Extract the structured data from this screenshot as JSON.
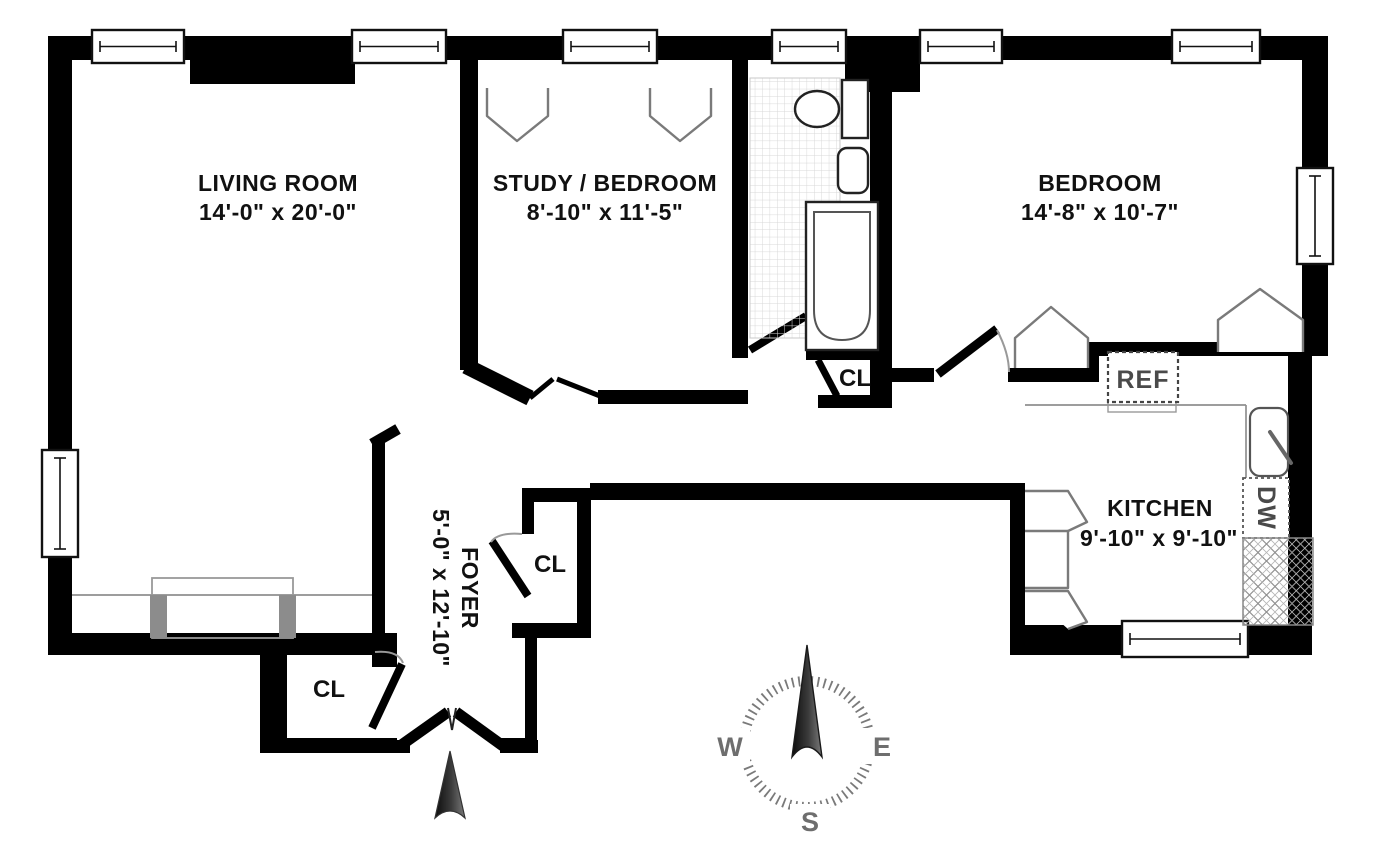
{
  "rooms": {
    "living": {
      "name": "LIVING ROOM",
      "dims": "14'-0\" x 20'-0\""
    },
    "study": {
      "name": "STUDY / BEDROOM",
      "dims": "8'-10\" x 11'-5\""
    },
    "bedroom": {
      "name": "BEDROOM",
      "dims": "14'-8\" x 10'-7\""
    },
    "kitchen": {
      "name": "KITCHEN",
      "dims": "9'-10\" x 9'-10\""
    },
    "foyer": {
      "name": "FOYER",
      "dims": "5'-0\" x 12'-10\""
    }
  },
  "closets": {
    "bath_closet": "CL",
    "foyer_closet": "CL",
    "entry_closet": "CL"
  },
  "appliances": {
    "refrigerator": "REF",
    "dishwasher": "DW"
  },
  "compass": {
    "west": "W",
    "east": "E",
    "south": "S"
  },
  "colors": {
    "wall": "#000000",
    "fixture_line": "#8f8f8f",
    "tile_line": "#d8d8d8",
    "gray_post": "#8c8c8c",
    "compass_text": "#6e6e6e",
    "appliance_text": "#4a4a4a"
  }
}
